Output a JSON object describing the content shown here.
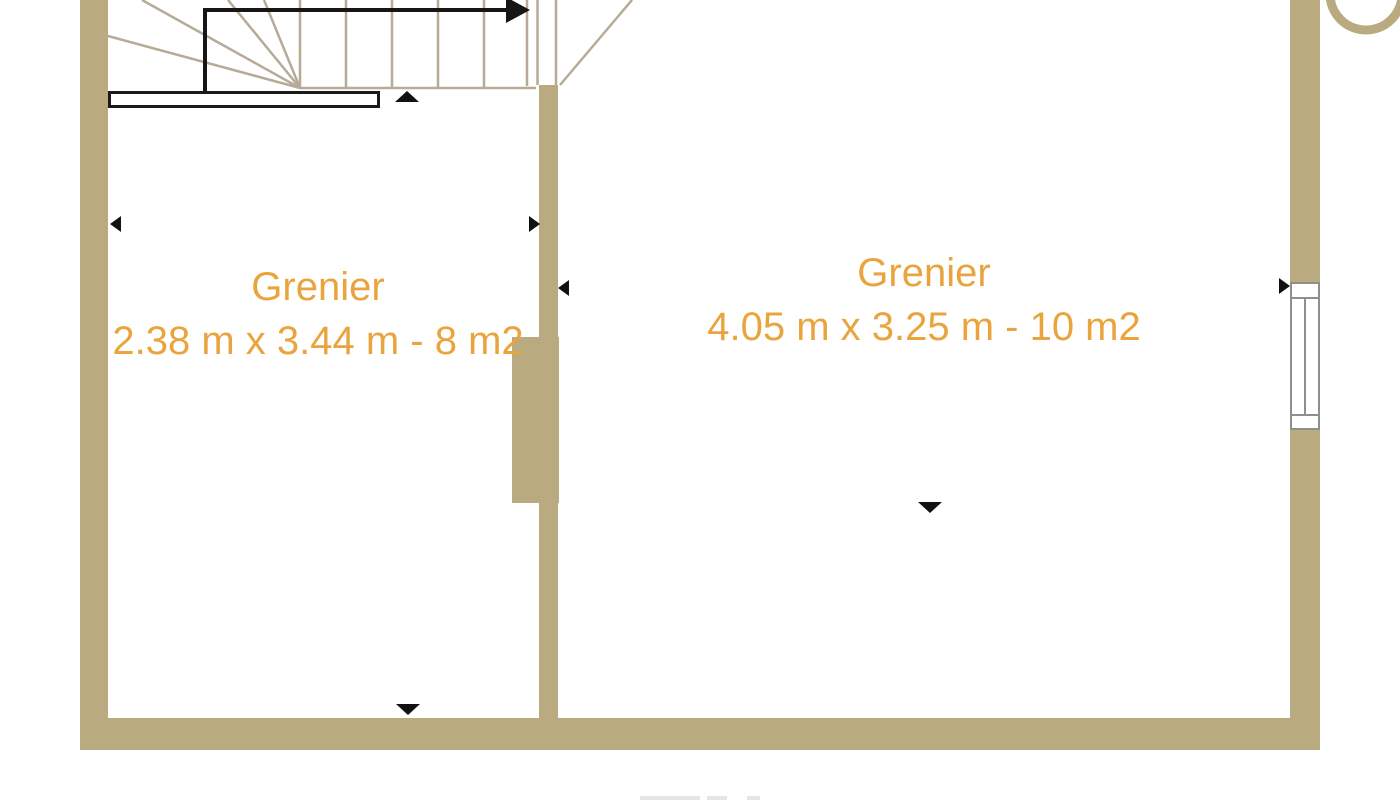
{
  "plan": {
    "type": "floor-plan",
    "floor_note": "attic level, image cropped at top and bottom",
    "rooms": [
      {
        "name": "Grenier",
        "dimensions": "2.38 m x 3.44 m - 8 m2"
      },
      {
        "name": "Grenier",
        "dimensions": "4.05 m x 3.25 m - 10 m2"
      }
    ],
    "features": {
      "stairs": "winder staircase top-left with up-direction arrow",
      "door": "door opening between stair hall and right room, leaf drawn open",
      "window": "window on right exterior wall",
      "markers": "black arrowheads marking measurement points on walls"
    },
    "colors": {
      "wall": "#b9aa80",
      "label": "#eaa43e",
      "stair_line": "#b7ab97",
      "window_frame": "#8f8f8f",
      "route_line": "#161616",
      "background": "#ffffff"
    }
  }
}
